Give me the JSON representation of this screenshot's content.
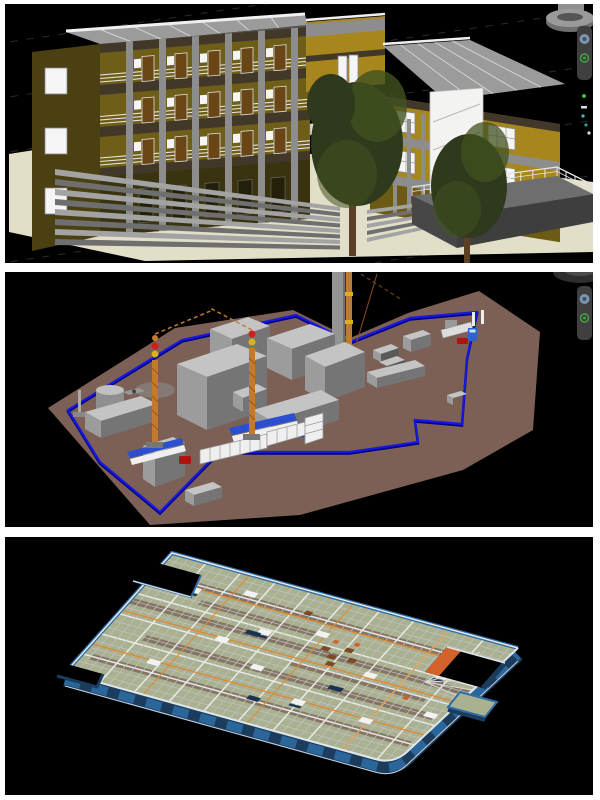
{
  "page": {
    "background": "#ffffff",
    "description": "Collage of three 3D construction-model viewport renders stacked vertically"
  },
  "panels": [
    {
      "name": "building-exterior-viewport",
      "alt": "3D rendering of a three-storey olive and mustard building with balconies, colonnade, wide entrance steps, roof terrace with white railing and two dark green trees on a black viewport background"
    },
    {
      "name": "site-layout-viewport",
      "alt": "3D construction site layout model: brown site plate with blue perimeter fence, grey massing blocks, two tower cranes, chimney with hoist mast, white site containers, material racks, gate with truck and cars"
    },
    {
      "name": "slab-formwork-viewport",
      "alt": "3D structural floor slab in isometric view with dense formwork beam grid, sage green decking, orange grid lines, dark blue perimeter walls, orange wall segment at a right-side opening and scattered small equipment"
    }
  ],
  "building": {
    "floors": 3,
    "bays_per_floor": 5,
    "wing_floors": 2,
    "wing_windows_per_floor": 3,
    "left_wall_windows": 3
  },
  "site": {
    "tower_cranes": 2,
    "boundary_color_name": "blue"
  },
  "navigation_bar": {
    "icons": [
      "steering-wheel-icon",
      "orbit-icon"
    ]
  },
  "colors": {
    "frame": "#ffffff",
    "viewportBg": "#000000",
    "gridline": "#2c2c2c",
    "groundCream": "#e2dfc9",
    "wallOliveLit": "#6e5e18",
    "wallOliveShade": "#4b4012",
    "wallMustard": "#a8861e",
    "bandDark": "#42382a",
    "columnGray": "#8d8d8d",
    "roofGray": "#9b9b9b",
    "roofLine": "#d8d8d8",
    "parapetWhite": "#f0f0f0",
    "windowWhite": "#f5f5f5",
    "doorBrown": "#6a4617",
    "railWhite": "#e6e6e6",
    "stepLight": "#a3a3a3",
    "stepDark": "#6f6f6f",
    "terraceTop": "#6e6e6e",
    "terraceFront": "#474747",
    "treeDark": "#2f3a1d",
    "treeMid": "#41511f",
    "trunkBrown": "#5c4026",
    "potGray": "#8c8c8c",
    "siteBrown": "#7c6055",
    "fenceBlue": "#1717dd",
    "fenceBlueDark": "#000088",
    "blockTop": "#c4c4c4",
    "blockFront": "#9c9c9c",
    "blockSide": "#757575",
    "craneOrange": "#c47a2e",
    "craneDark": "#8a4f18",
    "lightRed": "#cc2020",
    "lightYellow": "#d8b020",
    "containerWhite": "#efefef",
    "containerLine": "#9a9a9a",
    "truckBlue": "#2f63c9",
    "carRed": "#b01212",
    "rackBlue": "#2a4fd0",
    "chimneyGray": "#949494",
    "navBar": "#3f3f3f",
    "navIconBlue": "#7e95ad",
    "navIconGreen": "#43a543",
    "slabGreen": "#a9b190",
    "beamLight": "#e8e8e8",
    "beamMid": "#c2c2c2",
    "stripBrown": "#7e6c5d",
    "gridOrange": "#dd8a35",
    "wallNavy": "#1c3c5d",
    "wallBlue": "#2e6da4",
    "wallOrange": "#d2622a",
    "slabWhiteObj": "#f2f2f2",
    "slabNavyObj": "#173352",
    "slabBrownObj": "#7c4a26"
  }
}
